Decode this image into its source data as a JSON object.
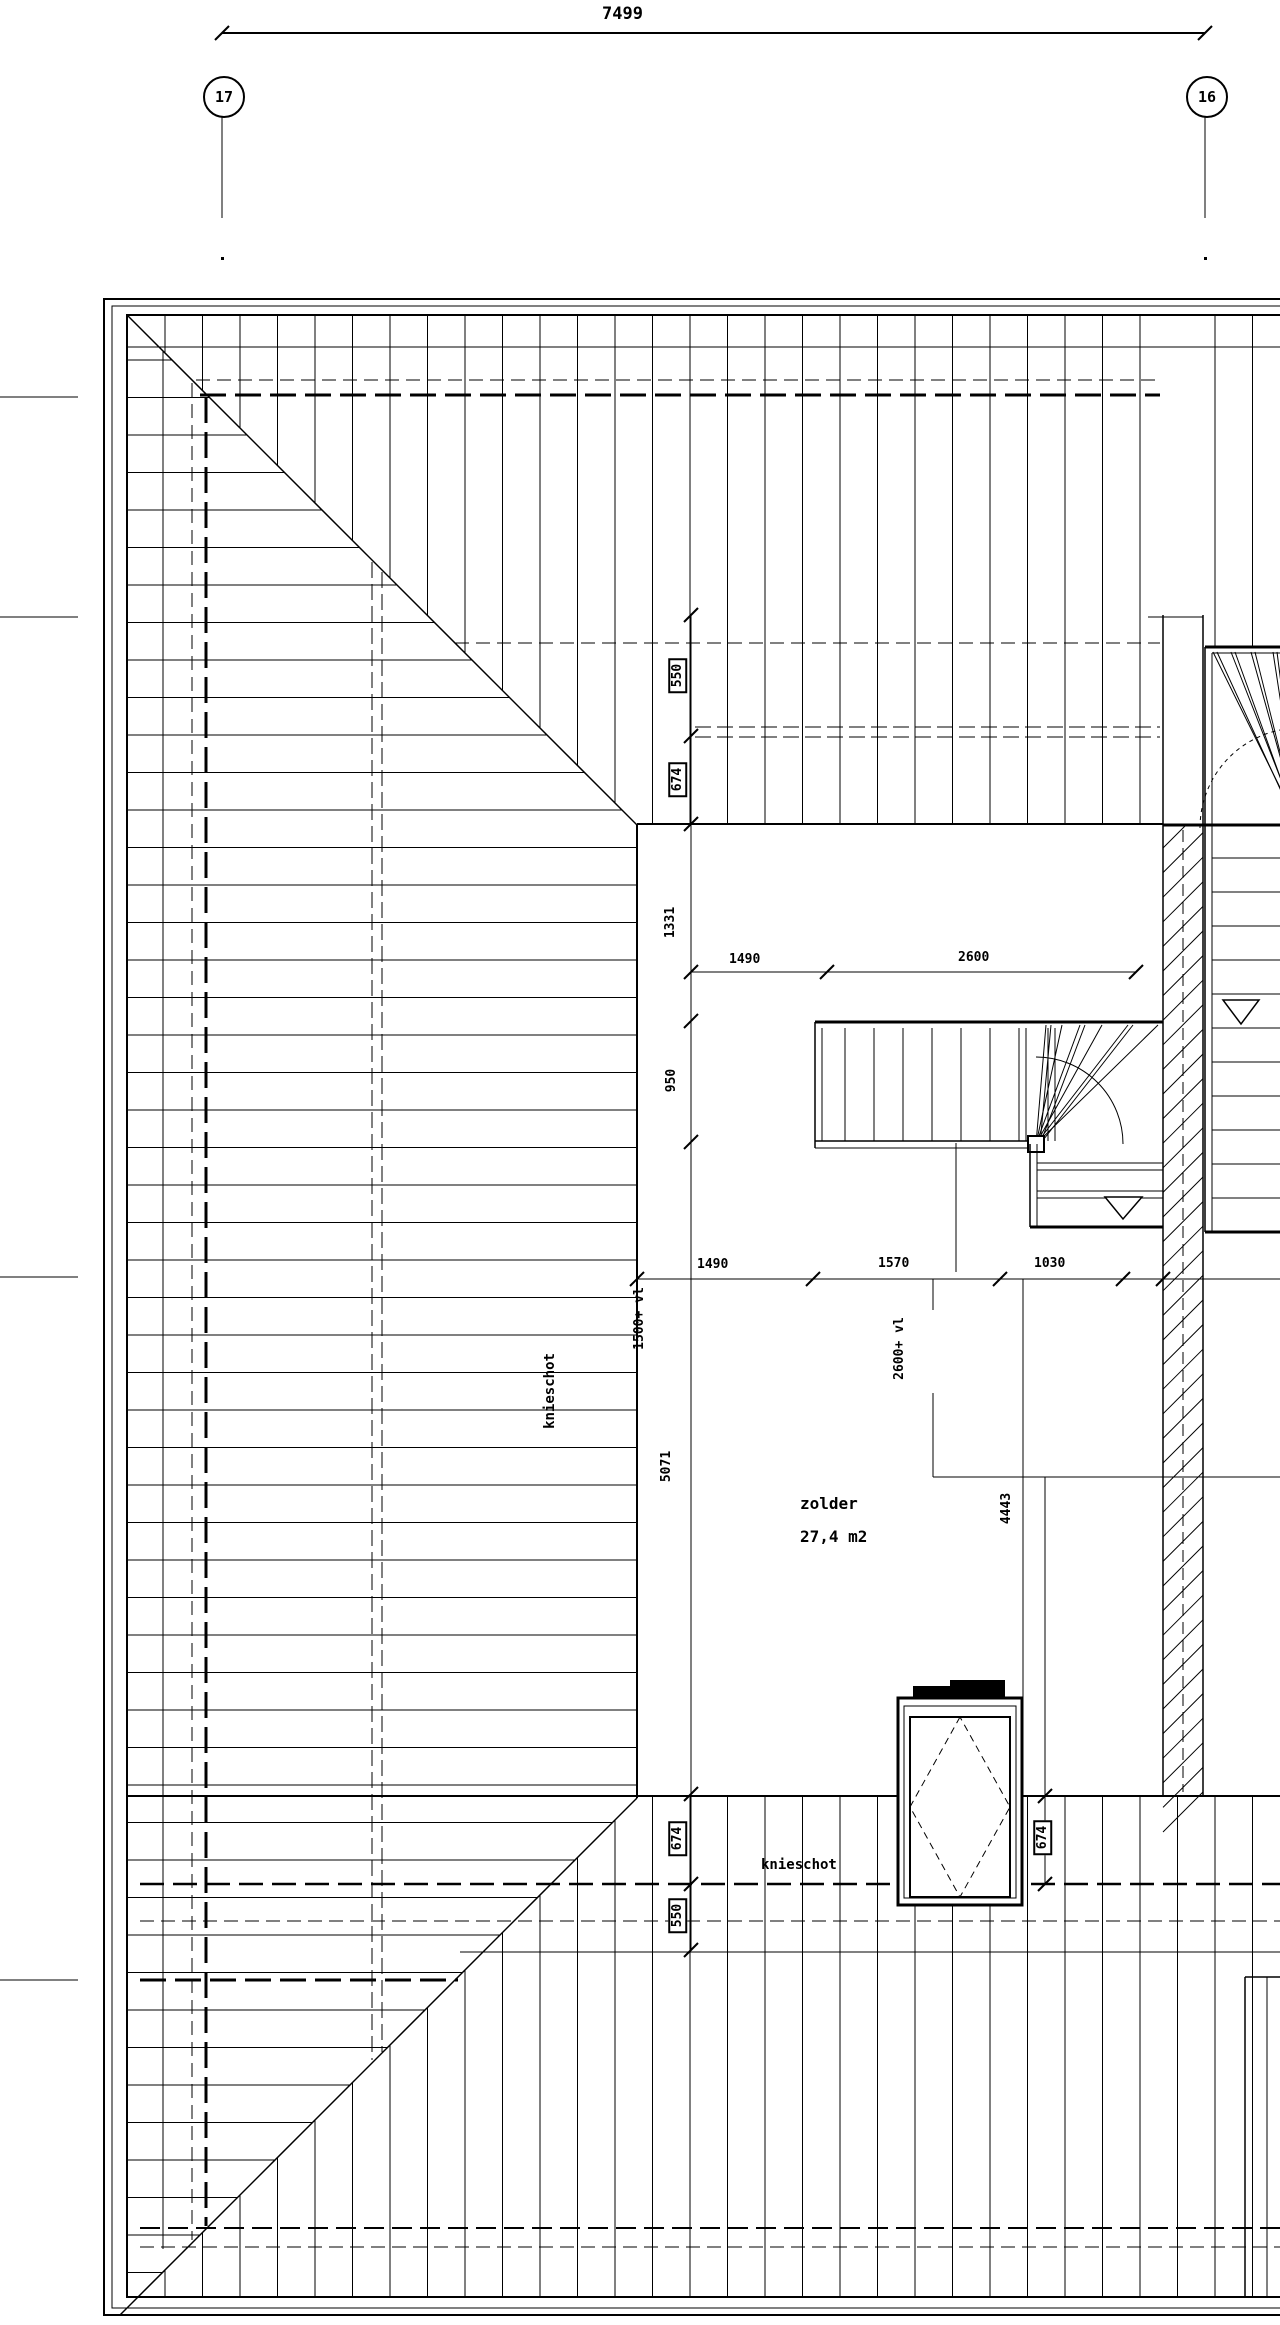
{
  "grid": {
    "top_dimension": "7499",
    "left_bubble": "17",
    "right_bubble": "16"
  },
  "dimensions": {
    "upper": {
      "a": "1490",
      "b": "2600"
    },
    "lower": {
      "a": "1490",
      "b": "1570",
      "c": "1030"
    },
    "left_vertical": {
      "t550": "550",
      "t674": "674",
      "m1331": "1331",
      "m950": "950",
      "m5071": "5071",
      "b674": "674",
      "b550": "550"
    },
    "right_vertical": {
      "r674": "674",
      "r4443": "4443"
    }
  },
  "levels": {
    "left": "1500+ vl",
    "center": "2600+ vl"
  },
  "room": {
    "name": "zolder",
    "area": "27,4 m2"
  },
  "labels": {
    "knieschot_left": "knieschot",
    "knieschot_bottom": "knieschot"
  }
}
